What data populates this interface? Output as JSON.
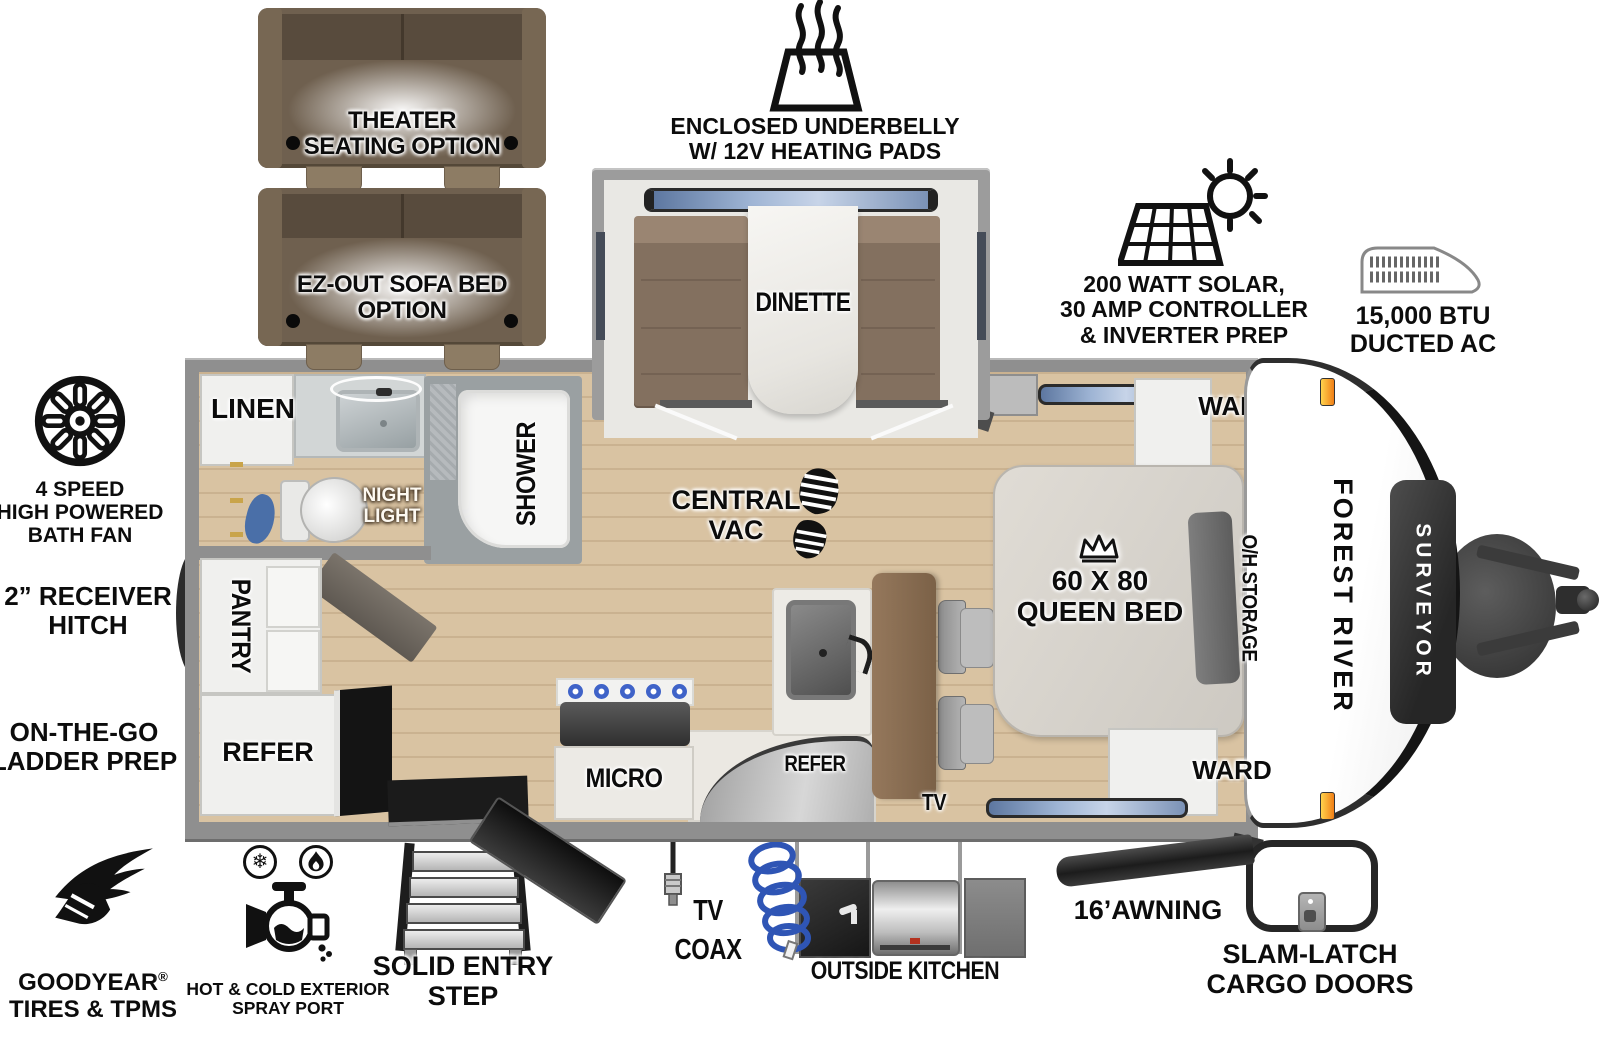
{
  "brand": {
    "make": "FOREST RIVER",
    "model": "SURVEYOR"
  },
  "options": {
    "theater": "THEATER\nSEATING OPTION",
    "ez_out": "EZ-OUT SOFA BED\nOPTION"
  },
  "exterior_features": {
    "underbelly": "ENCLOSED UNDERBELLY\nW/ 12V HEATING PADS",
    "solar": "200 WATT SOLAR,\n30 AMP CONTROLLER\n& INVERTER PREP",
    "ac": "15,000 BTU\nDUCTED AC",
    "bath_fan": "4 SPEED\nHIGH POWERED\nBATH FAN",
    "receiver_hitch": "2” RECEIVER\nHITCH",
    "ladder_prep": "ON-THE-GO\nLADDER PREP",
    "goodyear_brand": "GOODYEAR",
    "goodyear_reg": "®",
    "goodyear_line2": "TIRES & TPMS",
    "spray_port": "HOT & COLD EXTERIOR\nSPRAY PORT",
    "entry_step": "SOLID ENTRY\nSTEP",
    "tv_coax": "TV\nCOAX",
    "outside_kitchen": "OUTSIDE KITCHEN",
    "awning": "16’AWNING",
    "cargo_doors": "SLAM-LATCH\nCARGO DOORS"
  },
  "interior_labels": {
    "linen": "LINEN",
    "night_light": "NIGHT\nLIGHT",
    "shower": "SHOWER",
    "pantry": "PANTRY",
    "refer_rear": "REFER",
    "micro": "MICRO",
    "central_vac": "CENTRAL\nVAC",
    "dinette": "DINETTE",
    "refer_kitchen": "REFER",
    "tv": "TV",
    "queen_bed": "60 X 80\nQUEEN BED",
    "ward_top": "WARD",
    "ward_bottom": "WARD",
    "oh_storage": "O/H STORAGE"
  },
  "colors": {
    "floor_wood": "#d9c3a2",
    "wall_gray": "#8f8f8f",
    "sofa_brown": "#6f604f",
    "bench_brown": "#83705f",
    "table_brown": "#8a6f52",
    "window_blue": "#8aa2c6",
    "marker_orange": "#f08217",
    "hose_blue": "#2f55b5"
  }
}
